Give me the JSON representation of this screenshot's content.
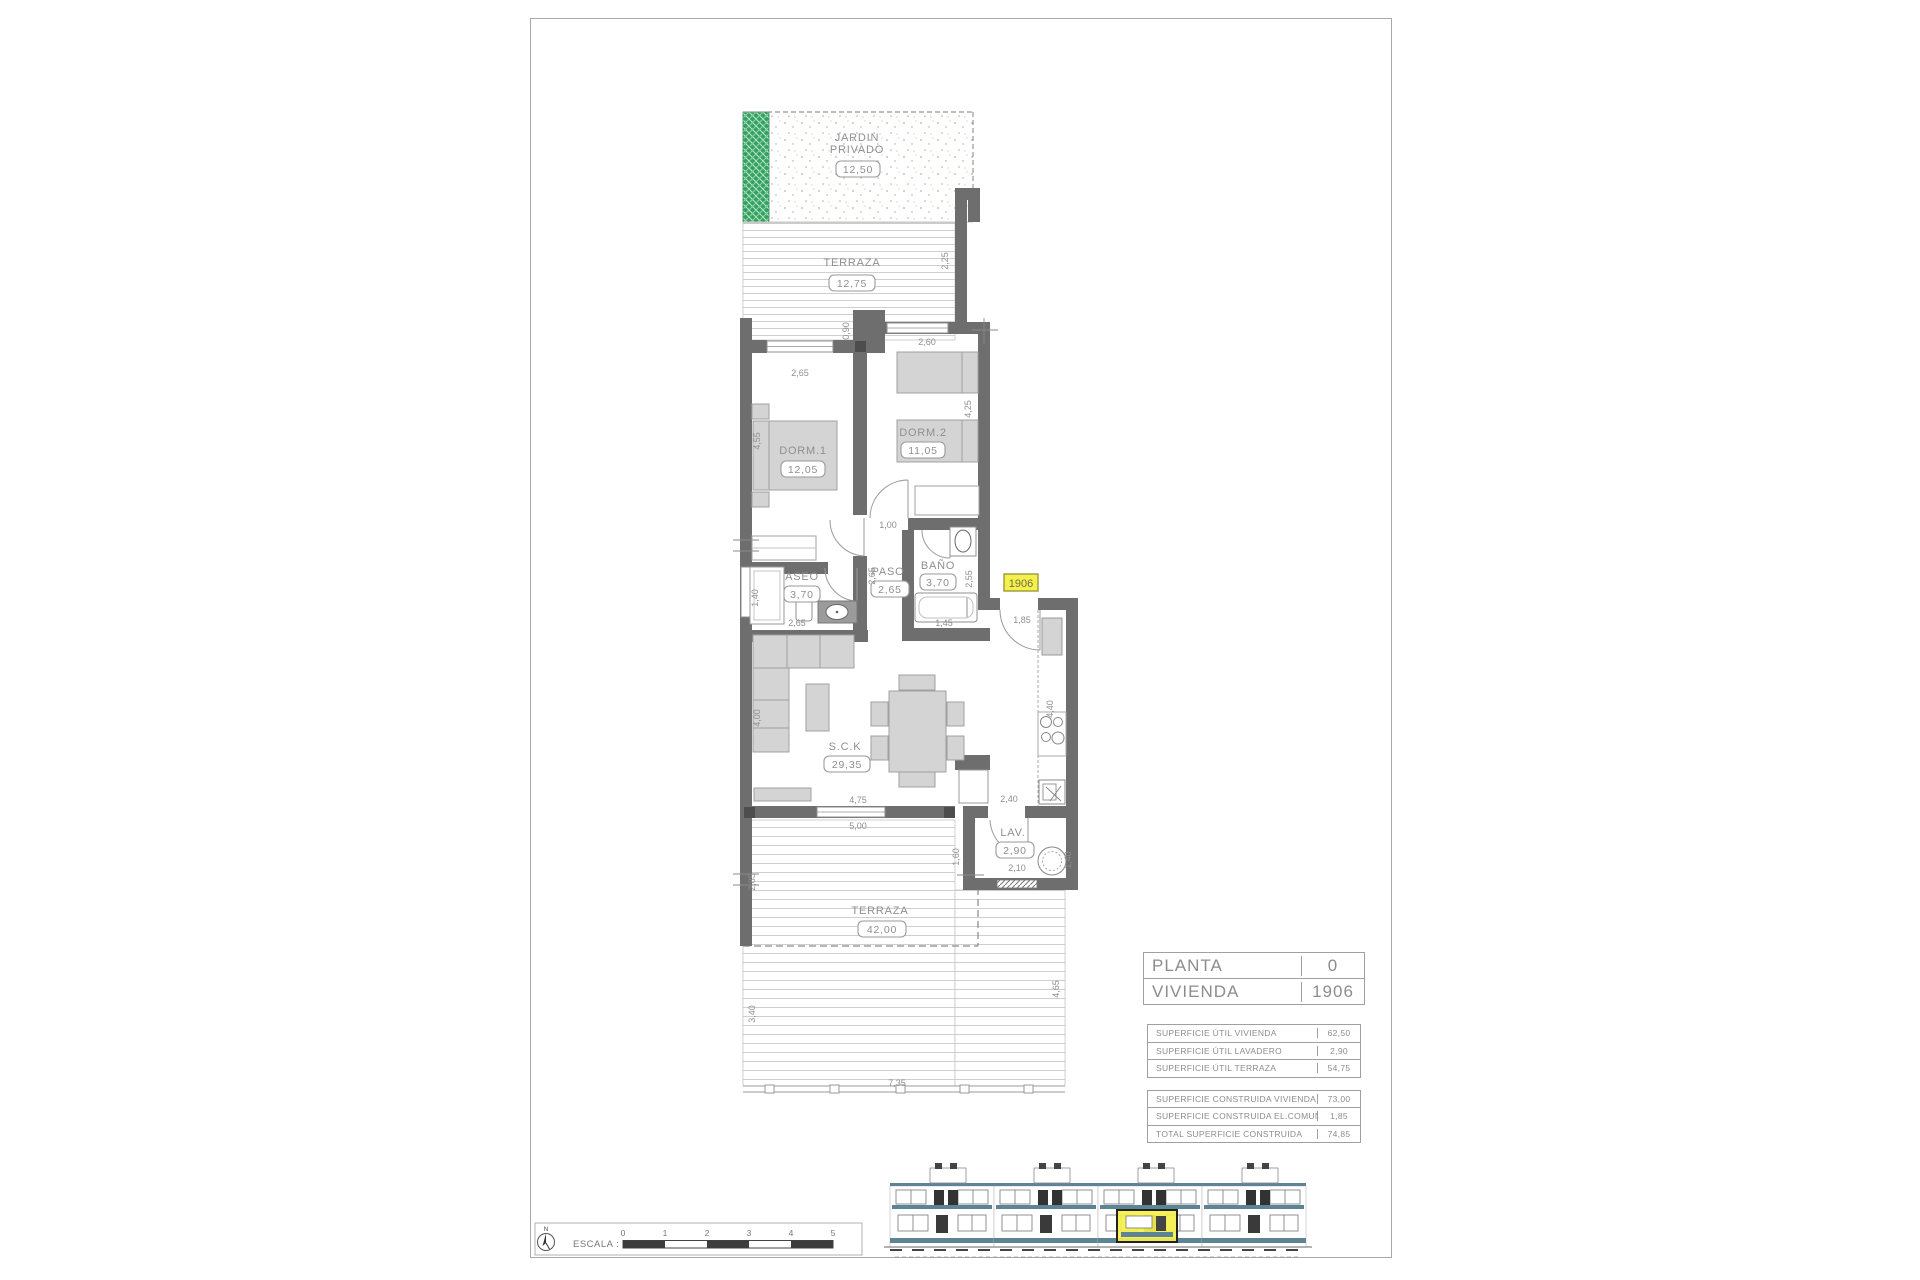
{
  "unit": "1906",
  "rooms": {
    "jardin": {
      "name1": "JARDIN",
      "name2": "PRIVADO",
      "area": "12,50"
    },
    "terraza_top": {
      "name": "TERRAZA",
      "area": "12,75"
    },
    "dorm1": {
      "name": "DORM.1",
      "area": "12,05"
    },
    "dorm2": {
      "name": "DORM.2",
      "area": "11,05"
    },
    "aseo": {
      "name": "ASEO",
      "area": "3,70"
    },
    "paso": {
      "name": "PASO",
      "area": "2,65"
    },
    "bano": {
      "name": "BAÑO",
      "area": "3,70"
    },
    "sck": {
      "name": "S.C.K",
      "area": "29,35"
    },
    "lav": {
      "name": "LAV.",
      "area": "2,90"
    },
    "terraza_bottom": {
      "name": "TERRAZA",
      "area": "42,00"
    }
  },
  "dims": {
    "dorm1_width": "2,65",
    "corner": "0,90",
    "dorm2_width": "2,60",
    "terraza_top_side": "2,25",
    "dorm1_depth": "4,55",
    "dorm2_depth": "4,25",
    "hall_door": "1,00",
    "paso_depth": "2,65",
    "aseo_width": "1,40",
    "aseo_length": "2,65",
    "bano_depth": "2,55",
    "bano_width": "1,45",
    "entry_width": "1,85",
    "kitchen_length": "4,40",
    "sck_depth": "4,00",
    "sck_width": "4,75",
    "terraza_width": "5,00",
    "kitchen_pass": "2,40",
    "lav_left": "1,60",
    "lav_width": "2,10",
    "lav_right": "1,40",
    "terraza_b_upper": "2,85",
    "terraza_b_left": "3,40",
    "terraza_b_right": "4,65",
    "terraza_b_width": "7,35"
  },
  "info_table": {
    "header_rows": [
      {
        "label": "PLANTA",
        "value": "0"
      },
      {
        "label": "VIVIENDA",
        "value": "1906"
      }
    ],
    "util_rows": [
      {
        "label": "SUPERFICIE ÚTIL VIVIENDA",
        "value": "62,50"
      },
      {
        "label": "SUPERFICIE ÚTIL LAVADERO",
        "value": "2,90"
      },
      {
        "label": "SUPERFICIE ÚTIL TERRAZA",
        "value": "54,75"
      }
    ],
    "built_rows": [
      {
        "label": "SUPERFICIE CONSTRUIDA VIVIENDA",
        "value": "73,00"
      },
      {
        "label": "SUPERFICIE CONSTRUIDA EL.COMUNES",
        "value": "1,85"
      },
      {
        "label": "TOTAL SUPERFICIE CONSTRUIDA",
        "value": "74,85"
      }
    ]
  },
  "scale_bar": {
    "label": "ESCALA :",
    "north": "N",
    "ticks": [
      "0",
      "1",
      "2",
      "3",
      "4",
      "5"
    ]
  },
  "colors": {
    "wall": "#6e6e6e",
    "furniture": "#d4d4d4",
    "garden_green": "#35a060",
    "highlight_yellow": "#f5f04b",
    "elevation_slab": "#5d8494"
  }
}
